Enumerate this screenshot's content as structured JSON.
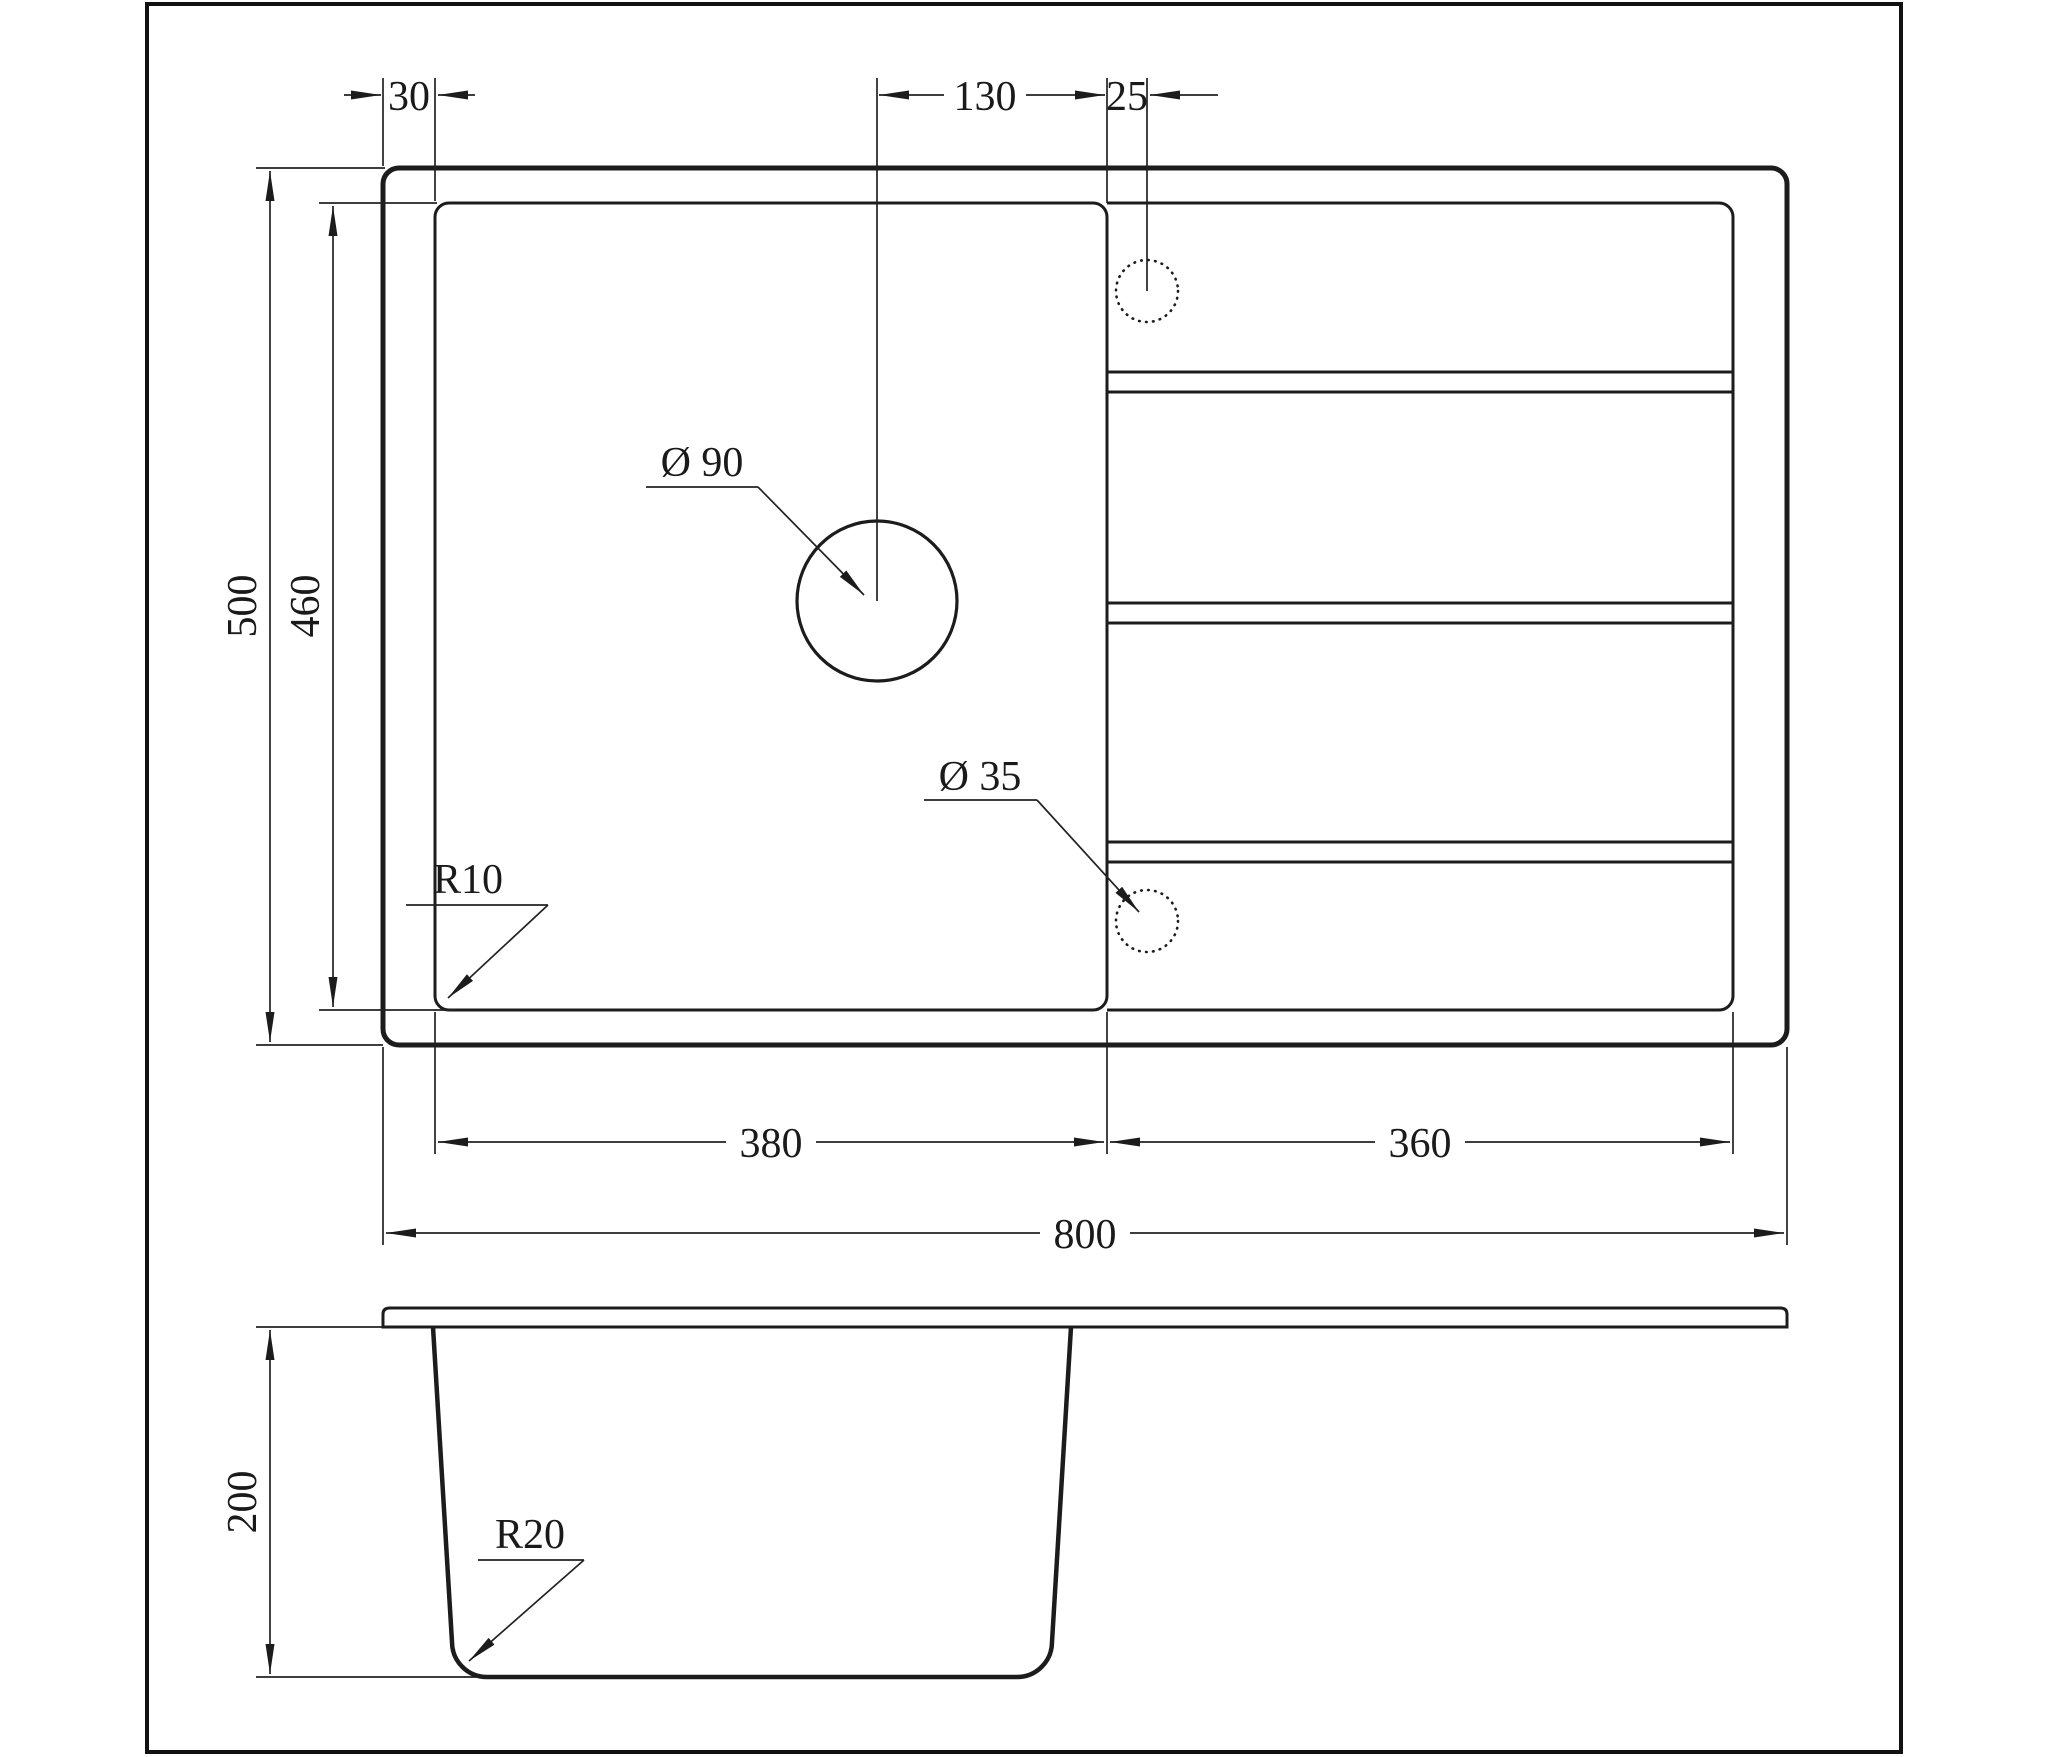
{
  "dimensions": {
    "left_margin": "30",
    "drain_to_divider": "130",
    "tap_to_divider": "25",
    "overall_depth": "500",
    "bowl_depth": "460",
    "bowl_width": "380",
    "drainboard_width": "360",
    "overall_width": "800",
    "bowl_height": "200",
    "drain_hole": "Ø 90",
    "tap_hole": "Ø 35",
    "bowl_corner_radius": "R10",
    "bottom_corner_radius": "R20"
  },
  "colors": {
    "line": "#1c1c1c",
    "text": "#1a1a1a",
    "background": "#ffffff"
  }
}
